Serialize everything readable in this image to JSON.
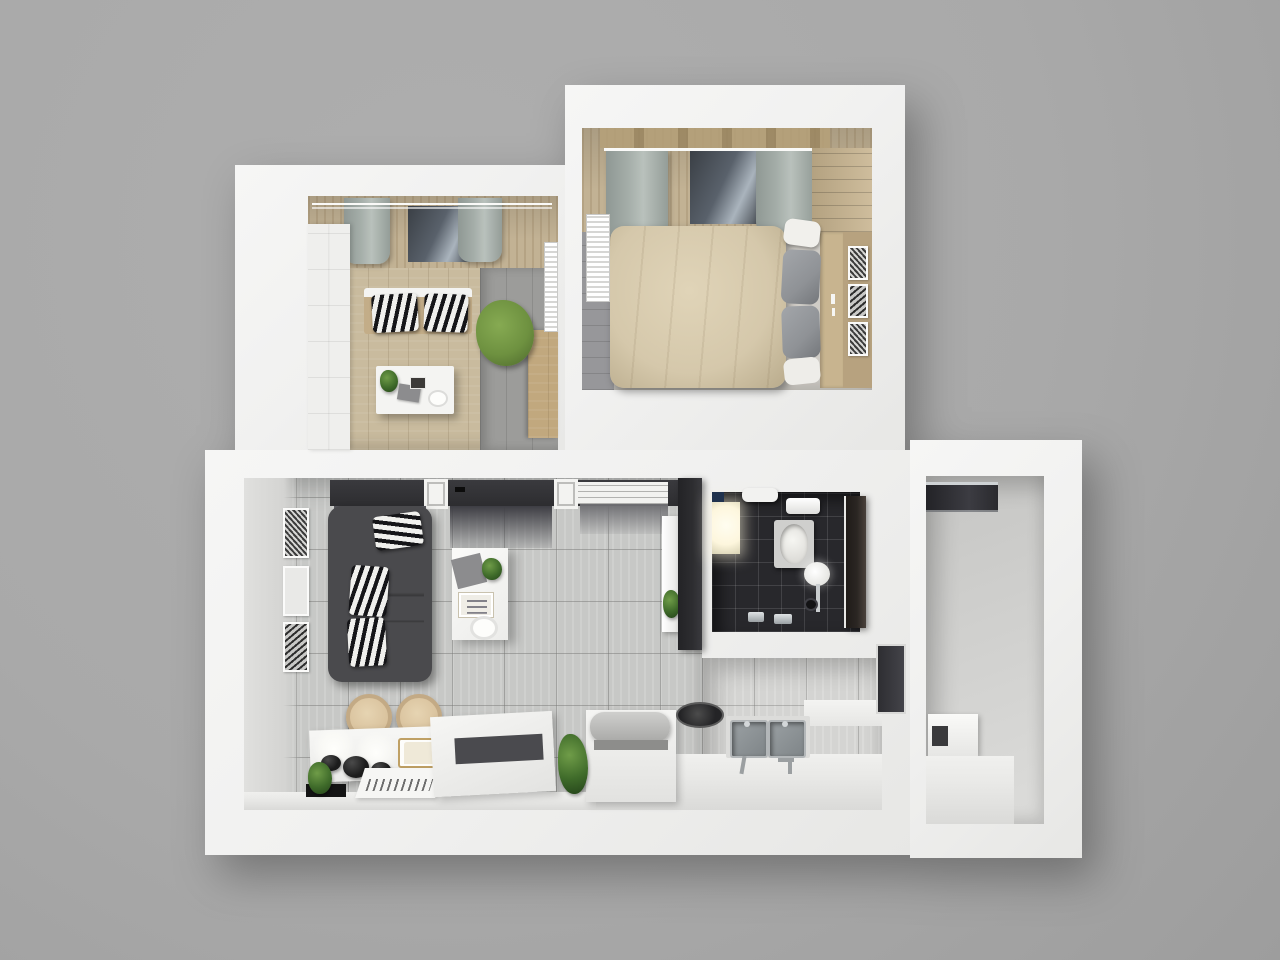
{
  "scene": {
    "type": "3d-floor-plan-render",
    "view": "top-down-isometric",
    "rooms": [
      {
        "id": "office",
        "name": "office-kids-room",
        "floor": "wood-plank",
        "items": [
          "white-panel-wardrobe",
          "window-curtains",
          "daybed",
          "zebra-pillows",
          "green-chair",
          "white-desk",
          "desk-plant",
          "laptop",
          "radiator",
          "side-cabinet"
        ]
      },
      {
        "id": "bedroom",
        "name": "bedroom",
        "floor": "gray-plank",
        "items": [
          "double-bed-beige-duvet",
          "gray-pillows",
          "white-pillow",
          "headboard-console",
          "candles",
          "step-shelf-wardrobe",
          "window-curtains",
          "radiator",
          "picture-frames"
        ]
      },
      {
        "id": "living-room",
        "name": "living-room",
        "floor": "light-gray-tile",
        "items": [
          "dark-gray-sofa",
          "zebra-pillows",
          "coffee-table",
          "table-plant",
          "gray-cloth",
          "magazine-tray",
          "round-plate",
          "wall-art-frames",
          "built-in-closets",
          "door-frames",
          "door-mats",
          "tall-white-cabinet",
          "cabinet-plant",
          "charcoal-partition"
        ]
      },
      {
        "id": "dining-bar",
        "name": "dining-bar-corner",
        "floor": "light-gray-tile",
        "items": [
          "bar-counter",
          "spotlight-glows",
          "black-bowls",
          "gold-serving-tray",
          "menu-cards",
          "black-mat",
          "small-plant",
          "bar-stools",
          "white-table",
          "dark-table-mat"
        ]
      },
      {
        "id": "kitchen",
        "name": "kitchen",
        "floor": "light-gray-tile",
        "items": [
          "island-unit",
          "covered-appliance",
          "cooktop",
          "double-stainless-sink",
          "faucets",
          "counter-run",
          "floor-plant",
          "balcony-door"
        ]
      },
      {
        "id": "bathroom",
        "name": "bathroom",
        "floor": "dark-tile",
        "items": [
          "bathtub",
          "round-sink",
          "sink-faucet",
          "floor-drain",
          "lit-shower-tray",
          "wall-shelf",
          "water-heater",
          "wall-device",
          "chrome-taps",
          "open-dark-door"
        ]
      },
      {
        "id": "balcony",
        "name": "balcony-utility",
        "floor": "concrete",
        "items": [
          "dark-window-band",
          "white-appliance",
          "ledge-counter"
        ]
      }
    ]
  },
  "colors": {
    "bg": "#a9a9a9",
    "wall": "#f1f1f0",
    "tile": "#c7c8c6",
    "tileLight": "#d4d4d2",
    "officeWood": "#c9bb9e",
    "officeGray": "#9c9c9a",
    "plank": "#97979a",
    "charcoal": "#2d2d30",
    "sofa": "#4a4a4d",
    "sofaSeat": "#5a5a5d",
    "zebraDark": "#151518",
    "zebraLight": "#f0f0ed",
    "duvet": "#d5c8ab",
    "pillowGray": "#8f9296",
    "wood": "#b7a27f",
    "woodLight": "#c8b48f",
    "curtainBeige": "#c2b294",
    "curtainGray": "#a4ada8",
    "windowDark": "#3a3f45",
    "glass": "#aab4bd",
    "green": "#6e9140",
    "plantG": "#3f6b2a",
    "darkTile": "#28282c",
    "glow": "#fdf6dd",
    "stainlessB": "#b3b7b9",
    "stainlessI": "#7f8588",
    "stool": "#d9c29d",
    "gold": "#bfa064",
    "doorDark": "#2b2623",
    "balconyFloor": "#d0d0ce",
    "matDark": "#3e3e44",
    "matMid": "#55555b",
    "counter": "#e9e9e7",
    "frameWhite": "#fbfbfa"
  }
}
